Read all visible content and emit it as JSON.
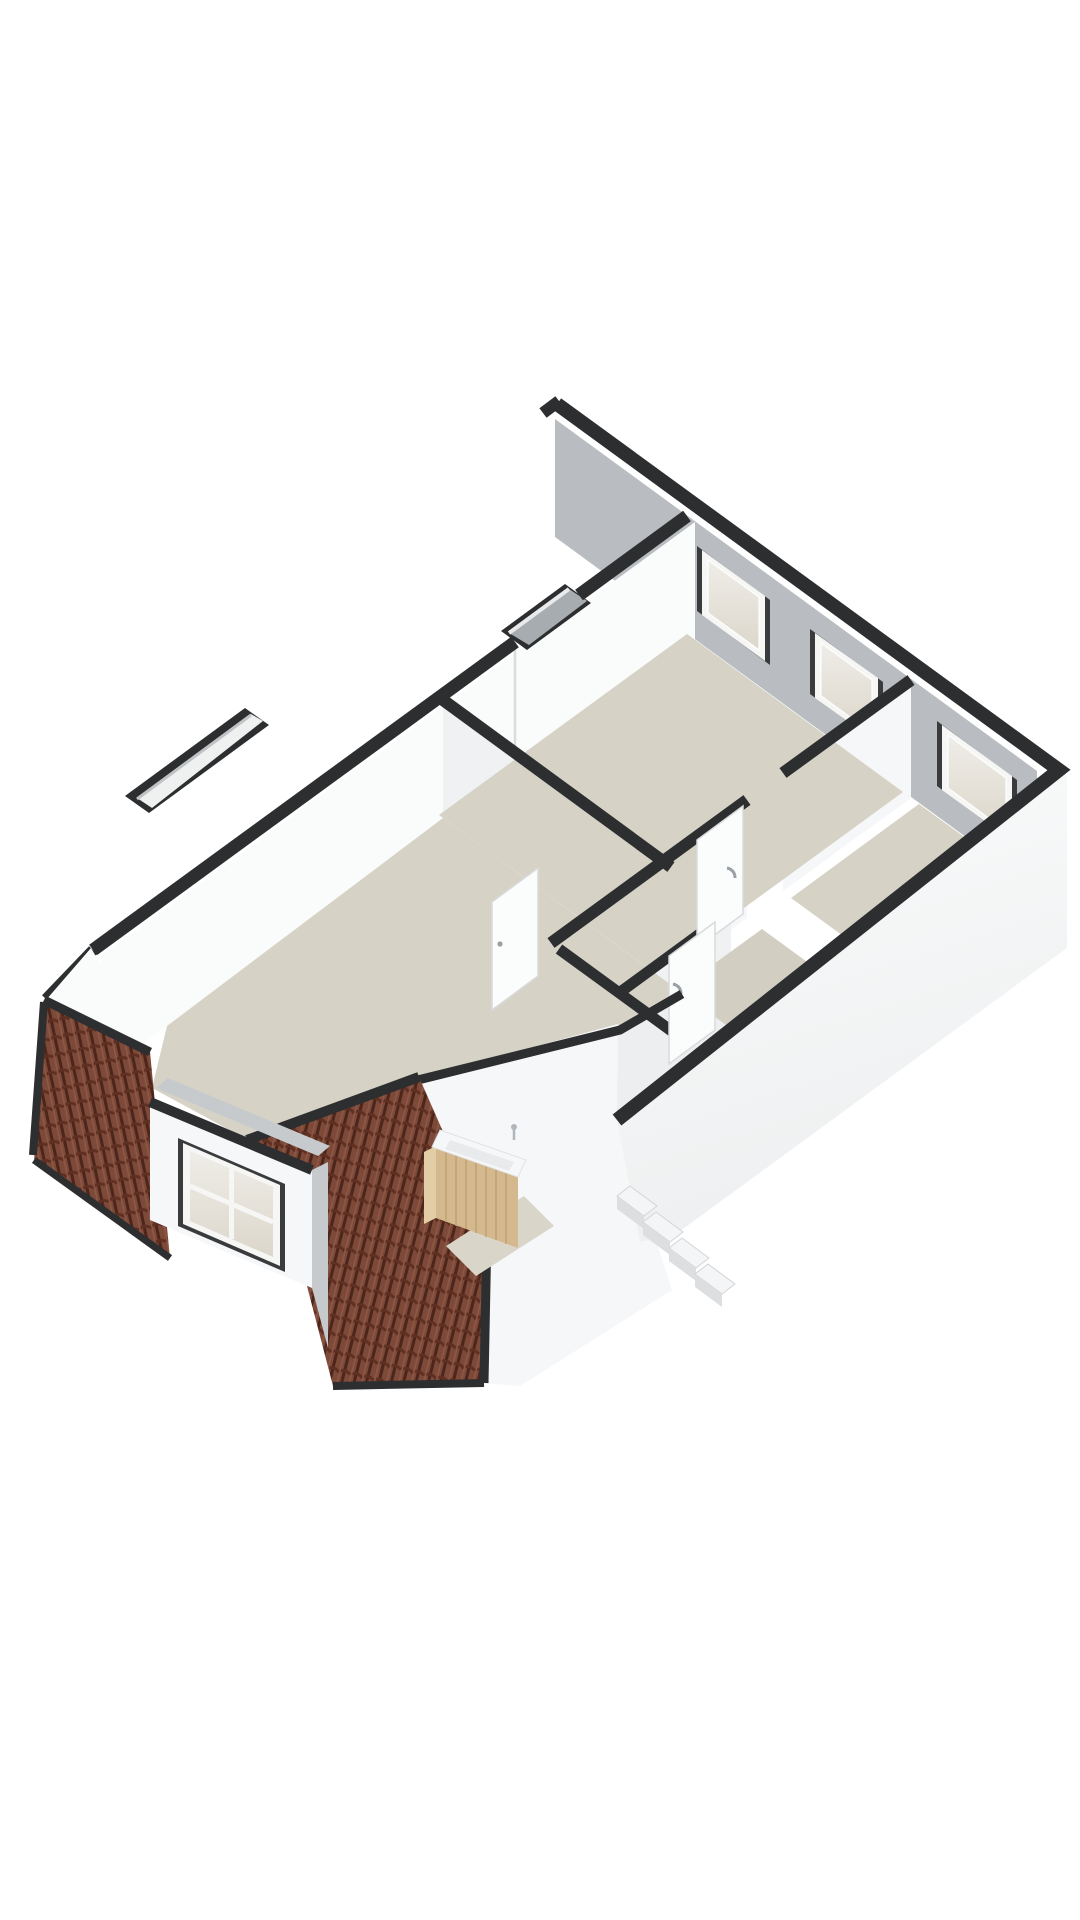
{
  "scene": {
    "background": "#ffffff",
    "view": "axonometric-3d-floor-plan",
    "level": "attic-floor",
    "text_labels": []
  },
  "palette": {
    "cap": "#2d2e30",
    "cap_soft": "#3a3b3d",
    "wall_white": "#fafbfb",
    "wall_shaded": "#eff1f2",
    "wall_bright": "#f6f7f8",
    "wall_gray": "#b9bdc1",
    "wall_midgray": "#c6cacd",
    "floor_main": "#d6d2c6",
    "floor_strip": "#d2cec2",
    "floor_light": "#eceeef",
    "floor_landing": "#d9d5c9",
    "glass_top": "#efede8",
    "glass_bottom": "#dcd7cb",
    "frame_white": "#f6f6f5",
    "flue_gray": "#a6acb0",
    "slot_inner": "#eff0f0",
    "seam": "#d9dbdd",
    "roof_base": "#7d4939",
    "roof_dark": "#4c251b",
    "roof_mid": "#5f2f22",
    "roof_light": "#8e5946",
    "wood": "#d4b88e",
    "wood_dark": "#c0a173",
    "wood_side": "#e3cda6",
    "sink_white": "#f6f7f8",
    "sink_inner": "#e8eaeb",
    "metal": "#b0b6bb",
    "door_white": "#fbfcfc",
    "door_edge": "#d8dadc",
    "handle": "#9aa0a5",
    "stair_tread": "#f4f5f6",
    "stair_riser": "#dcdee0",
    "stair_edge": "#d2d4d6",
    "se_face_top": "#fbfcfc",
    "se_face_bottom": "#edeff0"
  },
  "inventory": {
    "rooms": [
      {
        "id": "bedroom-top",
        "floor": "beige",
        "facade_windows": 2
      },
      {
        "id": "bedroom-right",
        "floor": "beige",
        "facade_windows": 1
      },
      {
        "id": "stair-strip",
        "floor": "beige",
        "facade_windows": 0
      },
      {
        "id": "hall",
        "floor": "light-gray",
        "facade_windows": 0
      },
      {
        "id": "landing",
        "floor": "beige",
        "facade_windows": 0
      },
      {
        "id": "main-room-left",
        "floor": "beige",
        "facade_windows": 0
      }
    ],
    "features": [
      {
        "id": "facade-window",
        "count": 3
      },
      {
        "id": "dormer-window",
        "count": 1,
        "panes": 4
      },
      {
        "id": "chimney-flue-opening",
        "count": 1
      },
      {
        "id": "roof-slot-opening",
        "count": 1
      },
      {
        "id": "roof-tile-section",
        "count": 2
      },
      {
        "id": "vanity-with-sink",
        "count": 1
      },
      {
        "id": "exterior-stair-steps",
        "count": 4
      },
      {
        "id": "door-leaf",
        "count": 3
      },
      {
        "id": "door-handle",
        "count": 3
      }
    ]
  }
}
